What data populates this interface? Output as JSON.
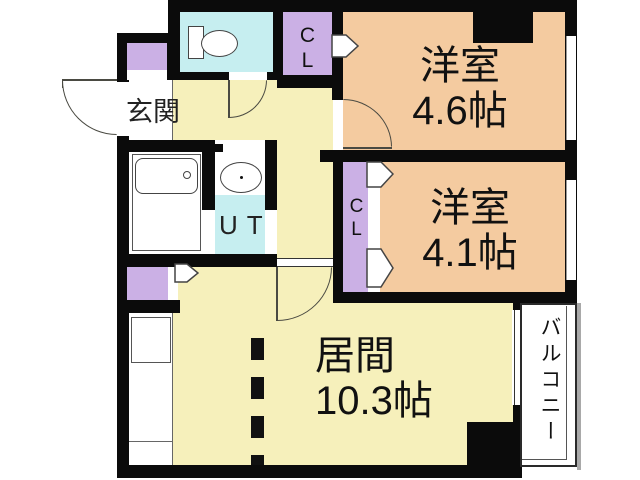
{
  "title": "apartment-floor-plan",
  "labels": {
    "entrance": "玄関",
    "room_46_name": "洋室",
    "room_46_size": "4.6帖",
    "room_41_name": "洋室",
    "room_41_size": "4.1帖",
    "living_name": "居間",
    "living_size": "10.3帖",
    "utility": "UT",
    "closet_upper": "CL",
    "closet_middle": "CL",
    "balcony": "バルコニー"
  },
  "colors": {
    "room_floor": "#f4cba0",
    "hall_floor": "#f6f0bb",
    "wet_area": "#c6eef0",
    "closet": "#cbb0e5",
    "wall": "#0b0b0b",
    "arc_line": "#4a4a42"
  }
}
